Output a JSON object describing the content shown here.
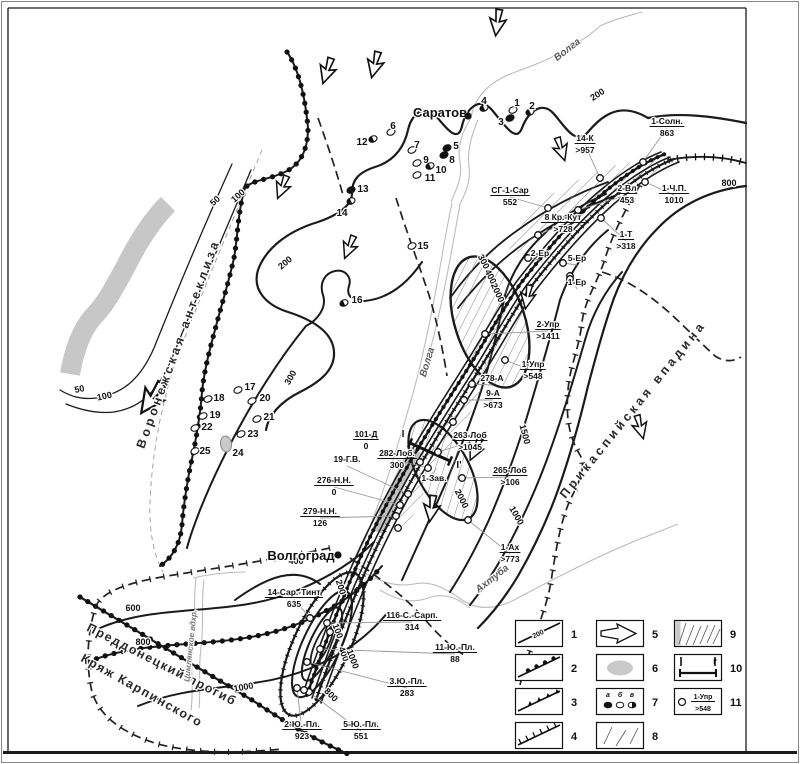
{
  "cities": [
    {
      "name": "Саратов",
      "tx": 440,
      "ty": 117,
      "dx": 468,
      "dy": 116
    },
    {
      "name": "Волгоград",
      "tx": 301,
      "ty": 560,
      "dx": 338,
      "dy": 555
    }
  ],
  "rivers": [
    {
      "name": "Волга",
      "x": 569,
      "y": 52,
      "r": -38,
      "small": false
    },
    {
      "name": "Волга",
      "x": 430,
      "y": 363,
      "r": -73,
      "small": false
    },
    {
      "name": "Ахтуба",
      "x": 494,
      "y": 581,
      "r": -38,
      "small": false
    },
    {
      "name": "Цимлянское вдхр.",
      "x": 193,
      "y": 646,
      "r": -84,
      "small": true
    }
  ],
  "regions": [
    {
      "name": "Воронежская антеклиза",
      "x": 182,
      "y": 345,
      "r": -70,
      "ls": 3.5
    },
    {
      "name": "Прикаспийская впадина",
      "x": 636,
      "y": 412,
      "r": -51,
      "ls": 3.5
    },
    {
      "name": "Преддонецкий прогиб",
      "x": 160,
      "y": 668,
      "r": 27,
      "ls": 1.5
    },
    {
      "name": "Кряж Карпинского",
      "x": 140,
      "y": 694,
      "r": 29,
      "ls": 1.5
    }
  ],
  "wells": [
    {
      "name": "1-Солн.",
      "value": "863",
      "x": 667,
      "y": 124,
      "cx": 643,
      "cy": 162
    },
    {
      "name": "14-К",
      "value": ">957",
      "x": 585,
      "y": 141,
      "cx": 600,
      "cy": 178
    },
    {
      "name": "СГ-1-Сар",
      "value": "552",
      "x": 510,
      "y": 193,
      "cx": 548,
      "cy": 208
    },
    {
      "name": "2-Вл",
      "value": "453",
      "x": 627,
      "y": 191,
      "cx": 578,
      "cy": 210
    },
    {
      "name": "1-Ч.П.",
      "value": "1010",
      "x": 674,
      "y": 191,
      "cx": 645,
      "cy": 182
    },
    {
      "name": "8 Кр.-Кут",
      "value": ">728",
      "x": 563,
      "y": 220,
      "cx": 538,
      "cy": 235
    },
    {
      "name": "1-Т",
      "value": ">318",
      "x": 626,
      "y": 237,
      "cx": 601,
      "cy": 218
    },
    {
      "name": "2-Ер",
      "value": null,
      "x": 540,
      "y": 256,
      "cx": 528,
      "cy": 258
    },
    {
      "name": "5-Ер",
      "value": null,
      "x": 577,
      "y": 261,
      "cx": 563,
      "cy": 263
    },
    {
      "name": "1-Ер",
      "value": null,
      "x": 577,
      "y": 285,
      "cx": 570,
      "cy": 276
    },
    {
      "name": "2-Упр",
      "value": ">1411",
      "x": 548,
      "y": 327,
      "cx": 485,
      "cy": 334
    },
    {
      "name": "1-Упр",
      "value": ">548",
      "x": 533,
      "y": 367,
      "cx": 505,
      "cy": 360
    },
    {
      "name": "278-А",
      "value": null,
      "x": 492,
      "y": 381,
      "cx": 472,
      "cy": 384
    },
    {
      "name": "9-А",
      "value": ">673",
      "x": 493,
      "y": 396,
      "cx": 464,
      "cy": 400
    },
    {
      "name": "101-Д",
      "value": "0",
      "x": 366,
      "y": 437,
      "cx": null,
      "cy": null
    },
    {
      "name": "263-Лоб",
      "value": ">1045",
      "x": 470,
      "y": 438,
      "cx": 438,
      "cy": 452
    },
    {
      "name": "282-Лоб.",
      "value": "300",
      "x": 397,
      "y": 456,
      "cx": 428,
      "cy": 468
    },
    {
      "name": "19-Г.В.",
      "value": null,
      "x": 347,
      "y": 462,
      "cx": 408,
      "cy": 494
    },
    {
      "name": "265-Лоб",
      "value": ">106",
      "x": 510,
      "y": 473,
      "cx": 462,
      "cy": 478
    },
    {
      "name": "276-Н.Н.",
      "value": "0",
      "x": 334,
      "y": 483,
      "cx": 400,
      "cy": 505
    },
    {
      "name": "1-Зав.",
      "value": null,
      "x": 434,
      "y": 481,
      "cx": null,
      "cy": null
    },
    {
      "name": "279-Н.Н.",
      "value": "126",
      "x": 320,
      "y": 514,
      "cx": 396,
      "cy": 516
    },
    {
      "name": "1-Ах",
      "value": ">773",
      "x": 510,
      "y": 550,
      "cx": 468,
      "cy": 520
    },
    {
      "name": "14-Сар.-Тинт",
      "value": "635",
      "x": 294,
      "y": 595,
      "cx": 310,
      "cy": 618
    },
    {
      "name": "116-С.-Сарп.",
      "value": "314",
      "x": 412,
      "y": 618,
      "cx": 327,
      "cy": 623
    },
    {
      "name": "11-Ю.-Пл.",
      "value": "88",
      "x": 455,
      "y": 650,
      "cx": 320,
      "cy": 649
    },
    {
      "name": "3.Ю.-Пл.",
      "value": "283",
      "x": 407,
      "y": 684,
      "cx": 307,
      "cy": 662
    },
    {
      "name": "2-Ю.-Пл.",
      "value": "923",
      "x": 302,
      "y": 727,
      "cx": 297,
      "cy": 688
    },
    {
      "name": "5-Ю.-Пл.",
      "value": "551",
      "x": 361,
      "y": 727,
      "cx": 309,
      "cy": 692
    }
  ],
  "points": [
    {
      "n": "1",
      "x": 513,
      "y": 110,
      "lx": 517,
      "ly": 103,
      "t": "open"
    },
    {
      "n": "2",
      "x": 530,
      "y": 112,
      "lx": 532,
      "ly": 106,
      "t": "half"
    },
    {
      "n": "3",
      "x": 510,
      "y": 118,
      "lx": 501,
      "ly": 122,
      "t": "filled"
    },
    {
      "n": "4",
      "x": 484,
      "y": 108,
      "lx": 484,
      "ly": 101,
      "t": "half"
    },
    {
      "n": "5",
      "x": 447,
      "y": 148,
      "lx": 456,
      "ly": 146,
      "t": "filled"
    },
    {
      "n": "6",
      "x": 391,
      "y": 132,
      "lx": 393,
      "ly": 126,
      "t": "open"
    },
    {
      "n": "7",
      "x": 412,
      "y": 150,
      "lx": 417,
      "ly": 145,
      "t": "open"
    },
    {
      "n": "8",
      "x": 444,
      "y": 155,
      "lx": 452,
      "ly": 160,
      "t": "filled"
    },
    {
      "n": "9",
      "x": 417,
      "y": 163,
      "lx": 426,
      "ly": 160,
      "t": "open"
    },
    {
      "n": "10",
      "x": 430,
      "y": 166,
      "lx": 441,
      "ly": 170,
      "t": "half"
    },
    {
      "n": "11",
      "x": 417,
      "y": 175,
      "lx": 430,
      "ly": 178,
      "t": "open"
    },
    {
      "n": "12",
      "x": 373,
      "y": 139,
      "lx": 362,
      "ly": 142,
      "t": "half"
    },
    {
      "n": "13",
      "x": 351,
      "y": 190,
      "lx": 363,
      "ly": 189,
      "t": "filled"
    },
    {
      "n": "14",
      "x": 351,
      "y": 201,
      "lx": 342,
      "ly": 213,
      "t": "half"
    },
    {
      "n": "15",
      "x": 412,
      "y": 246,
      "lx": 423,
      "ly": 246,
      "t": "open"
    },
    {
      "n": "16",
      "x": 344,
      "y": 303,
      "lx": 357,
      "ly": 300,
      "t": "half"
    },
    {
      "n": "17",
      "x": 238,
      "y": 390,
      "lx": 250,
      "ly": 387,
      "t": "open"
    },
    {
      "n": "18",
      "x": 208,
      "y": 399,
      "lx": 219,
      "ly": 398,
      "t": "open"
    },
    {
      "n": "19",
      "x": 203,
      "y": 416,
      "lx": 215,
      "ly": 415,
      "t": "open"
    },
    {
      "n": "20",
      "x": 252,
      "y": 401,
      "lx": 265,
      "ly": 398,
      "t": "open"
    },
    {
      "n": "21",
      "x": 257,
      "y": 419,
      "lx": 269,
      "ly": 417,
      "t": "open"
    },
    {
      "n": "22",
      "x": 195,
      "y": 428,
      "lx": 207,
      "ly": 427,
      "t": "open"
    },
    {
      "n": "23",
      "x": 241,
      "y": 434,
      "lx": 253,
      "ly": 434,
      "t": "open"
    },
    {
      "n": "24",
      "x": 226,
      "y": 444,
      "lx": 238,
      "ly": 453,
      "t": "gray"
    },
    {
      "n": "25",
      "x": 195,
      "y": 451,
      "lx": 205,
      "ly": 451,
      "t": "open"
    }
  ],
  "contour_labels": [
    {
      "t": "50",
      "x": 217,
      "y": 203,
      "r": -42
    },
    {
      "t": "100",
      "x": 240,
      "y": 198,
      "r": -42
    },
    {
      "t": "50",
      "x": 80,
      "y": 392,
      "r": -12
    },
    {
      "t": "100",
      "x": 105,
      "y": 399,
      "r": -12
    },
    {
      "t": "200",
      "x": 287,
      "y": 265,
      "r": -40
    },
    {
      "t": "300",
      "x": 293,
      "y": 379,
      "r": -60
    },
    {
      "t": "200",
      "x": 599,
      "y": 97,
      "r": -33
    },
    {
      "t": "800",
      "x": 729,
      "y": 186,
      "r": 0
    },
    {
      "t": "300",
      "x": 481,
      "y": 263,
      "r": 62
    },
    {
      "t": "400",
      "x": 488,
      "y": 278,
      "r": 62
    },
    {
      "t": "2000",
      "x": 495,
      "y": 294,
      "r": 65
    },
    {
      "t": "1500",
      "x": 522,
      "y": 435,
      "r": 75
    },
    {
      "t": "2000",
      "x": 459,
      "y": 500,
      "r": 63
    },
    {
      "t": "1000",
      "x": 514,
      "y": 517,
      "r": 60
    },
    {
      "t": "200",
      "x": 338,
      "y": 588,
      "r": 72
    },
    {
      "t": "100",
      "x": 335,
      "y": 632,
      "r": 70
    },
    {
      "t": "400",
      "x": 341,
      "y": 655,
      "r": 70
    },
    {
      "t": "1000",
      "x": 350,
      "y": 660,
      "r": 70
    },
    {
      "t": "800",
      "x": 329,
      "y": 697,
      "r": 45
    },
    {
      "t": "400",
      "x": 296,
      "y": 564,
      "r": 0
    },
    {
      "t": "600",
      "x": 133,
      "y": 611,
      "r": 0
    },
    {
      "t": "800",
      "x": 143,
      "y": 645,
      "r": 0
    },
    {
      "t": "1000",
      "x": 244,
      "y": 690,
      "r": -10
    }
  ],
  "section": {
    "x1": 410,
    "y1": 443,
    "x2": 450,
    "y2": 461,
    "start": "I",
    "end": "I'"
  },
  "arrows": [
    {
      "x": 497,
      "y": 26,
      "r": 8,
      "s": 1.1
    },
    {
      "x": 374,
      "y": 68,
      "r": 14,
      "s": 1.1
    },
    {
      "x": 326,
      "y": 74,
      "r": 18,
      "s": 1.1
    },
    {
      "x": 281,
      "y": 190,
      "r": 22,
      "s": 1
    },
    {
      "x": 348,
      "y": 250,
      "r": 22,
      "s": 1
    },
    {
      "x": 149,
      "y": 402,
      "r": 35,
      "s": 1.5
    },
    {
      "x": 562,
      "y": 152,
      "r": -18,
      "s": 1
    },
    {
      "x": 527,
      "y": 300,
      "r": 10,
      "s": 1
    },
    {
      "x": 474,
      "y": 452,
      "r": 25,
      "s": 1
    },
    {
      "x": 431,
      "y": 512,
      "r": 8,
      "s": 1.1
    },
    {
      "x": 641,
      "y": 430,
      "r": -15,
      "s": 1
    }
  ],
  "extra_circles": [
    [
      330,
      632
    ],
    [
      304,
      690
    ],
    [
      570,
      279
    ],
    [
      453,
      422
    ],
    [
      420,
      462
    ],
    [
      398,
      528
    ]
  ],
  "legend": {
    "items": [
      {
        "n": "1",
        "type": "contour",
        "text": "200"
      },
      {
        "n": "2",
        "type": "fault-beads"
      },
      {
        "n": "3",
        "type": "fault-triangles"
      },
      {
        "n": "4",
        "type": "fault-ticks"
      },
      {
        "n": "5",
        "type": "flow-arrow"
      },
      {
        "n": "6",
        "type": "gray-area"
      },
      {
        "n": "7",
        "type": "well-dots",
        "labels": [
          "а",
          "б",
          "в"
        ]
      },
      {
        "n": "8",
        "type": "hatch-sparse"
      },
      {
        "n": "9",
        "type": "hatch-dense"
      },
      {
        "n": "10",
        "type": "section-line",
        "labels": [
          "I",
          "I'"
        ]
      },
      {
        "n": "11",
        "type": "well-label",
        "name": "1-Упр",
        "value": ">548"
      }
    ]
  }
}
